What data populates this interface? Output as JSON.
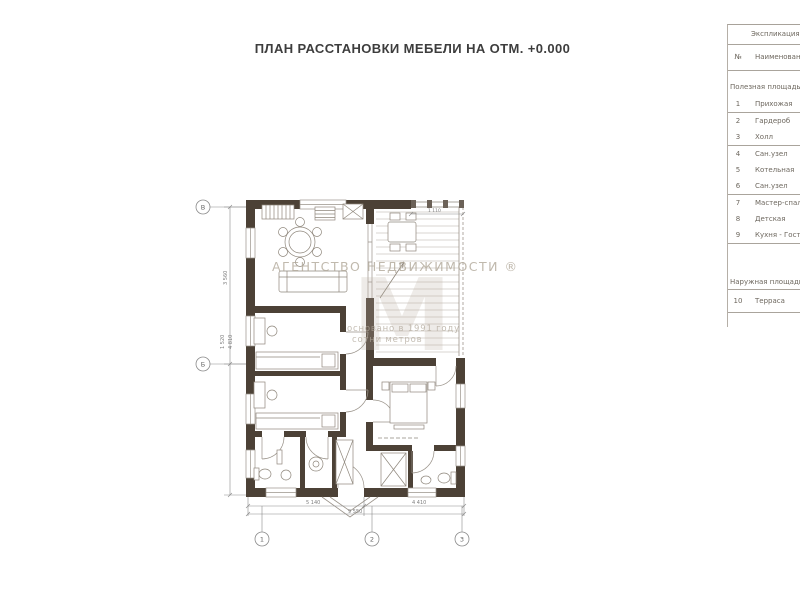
{
  "title": "ПЛАН РАССТАНОВКИ МЕБЕЛИ НА ОТМ. +0.000",
  "watermark": {
    "brand": "АГЕНТСТВО НЕДВИЖИМОСТИ ®",
    "logo_letter": "М",
    "line1": "основано в 1991 году",
    "line2": "сотни метров"
  },
  "explication": {
    "title": "Экспликация",
    "col_no": "№",
    "col_name": "Наименование",
    "sections": [
      {
        "label": "Полезная площадь",
        "rows": [
          {
            "no": "1",
            "name": "Прихожая"
          },
          {
            "no": "2",
            "name": "Гардероб"
          },
          {
            "no": "3",
            "name": "Холл"
          },
          {
            "no": "4",
            "name": "Сан.узел"
          },
          {
            "no": "5",
            "name": "Котельная"
          },
          {
            "no": "6",
            "name": "Сан.узел"
          },
          {
            "no": "7",
            "name": "Мастер-спальня"
          },
          {
            "no": "8",
            "name": "Детская"
          },
          {
            "no": "9",
            "name": "Кухня - Гостиная"
          }
        ]
      },
      {
        "label": "Наружная площадь",
        "rows": [
          {
            "no": "10",
            "name": "Терраса"
          }
        ]
      }
    ]
  },
  "axes": {
    "left": [
      "В",
      "Б"
    ],
    "bottom": [
      "1",
      "2",
      "3"
    ]
  },
  "dimensions": {
    "bottom_left": "5 140",
    "bottom_right": "4 410",
    "bottom_total": "9 550",
    "left_a": "3 560",
    "left_b": "1 520",
    "left_c": "4 810",
    "terrace_top": "1 110"
  },
  "colors": {
    "wall": "#4c4136",
    "line": "#9a938a",
    "furniture": "#8f877c",
    "dim": "#8a8a8a",
    "watermark": "#b4ab9e"
  }
}
